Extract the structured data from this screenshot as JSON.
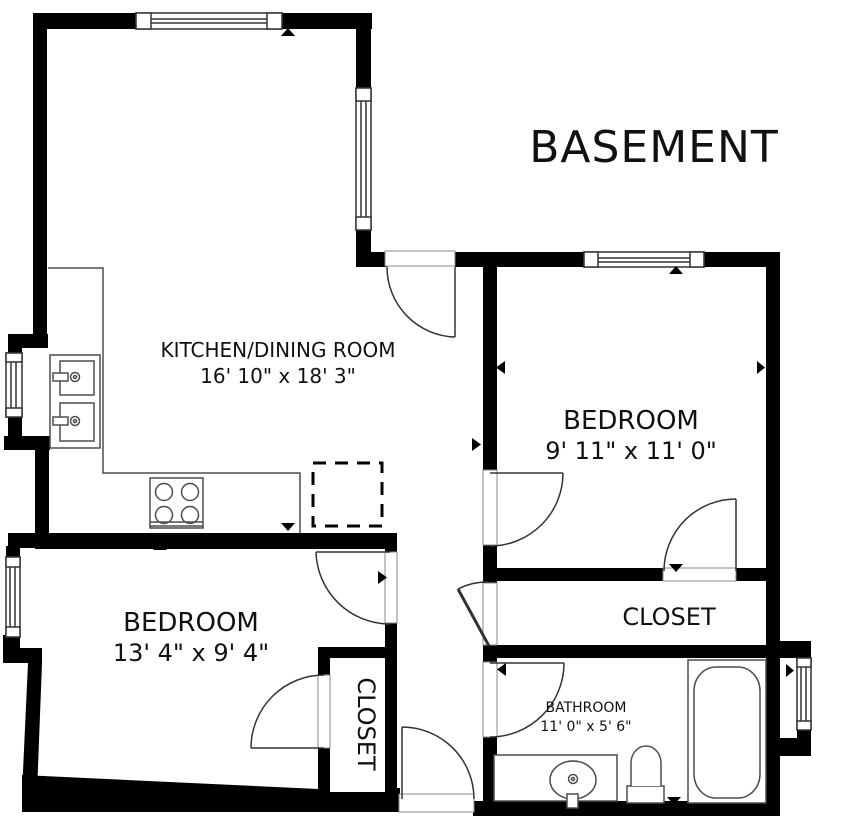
{
  "title": "BASEMENT",
  "rooms": {
    "kitchen": {
      "label": "KITCHEN/DINING ROOM",
      "dimensions": "16' 10\" x 18' 3\""
    },
    "bedroom_right": {
      "label": "BEDROOM",
      "dimensions": "9' 11\" x 11' 0\""
    },
    "bedroom_left": {
      "label": "BEDROOM",
      "dimensions": "13' 4\" x 9' 4\""
    },
    "closet_right": {
      "label": "CLOSET"
    },
    "closet_left": {
      "label": "CLOSET"
    },
    "bathroom": {
      "label": "BATHROOM",
      "dimensions": "11' 0\" x 5' 6\""
    }
  },
  "colors": {
    "wall": "#000000",
    "background": "#ffffff",
    "fixture_line": "#4d4d4d",
    "door_line": "#333333",
    "text": "#111111"
  }
}
